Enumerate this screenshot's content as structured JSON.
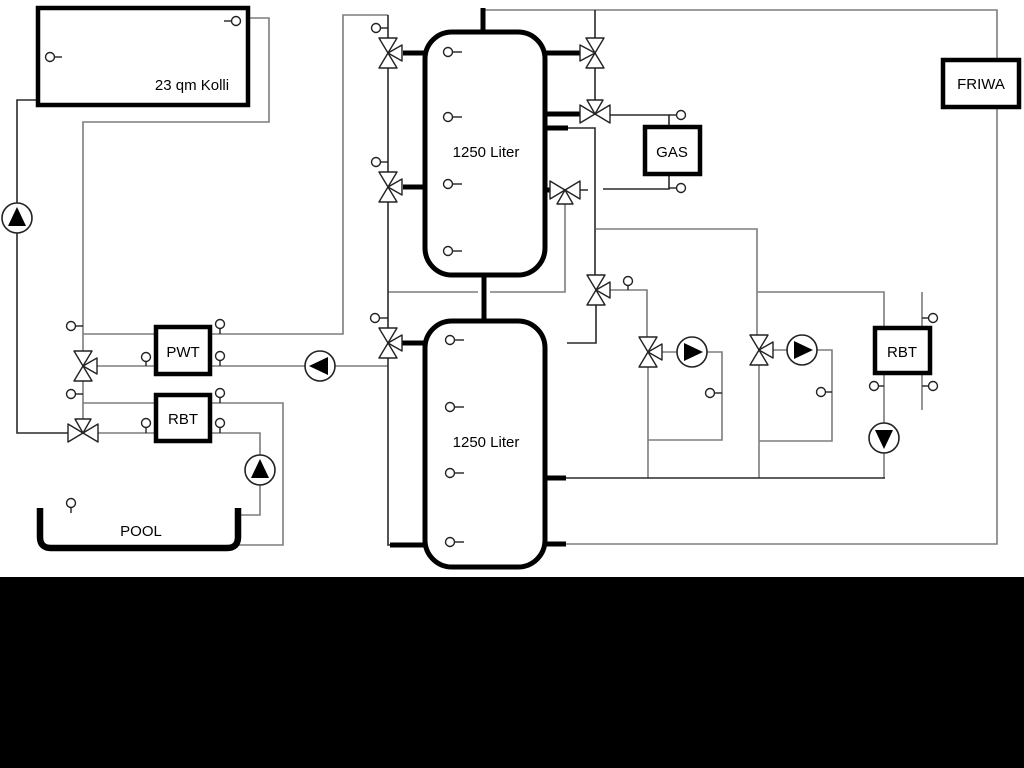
{
  "diagram": {
    "type": "heating-solar-hydraulic-schematic",
    "colors": {
      "background": "#ffffff",
      "pipe_gray": "#7d7d7d",
      "pipe_dark": "#2a2a2a",
      "component_outline": "#000000",
      "bottom_band": "#000000"
    },
    "labels": {
      "collector": "23 qm Kolli",
      "upper_tank": "1250 Liter",
      "lower_tank": "1250 Liter",
      "pwt": "PWT",
      "rbt_left": "RBT",
      "rbt_right": "RBT",
      "gas": "GAS",
      "friwa": "FRIWA",
      "pool": "POOL"
    }
  }
}
